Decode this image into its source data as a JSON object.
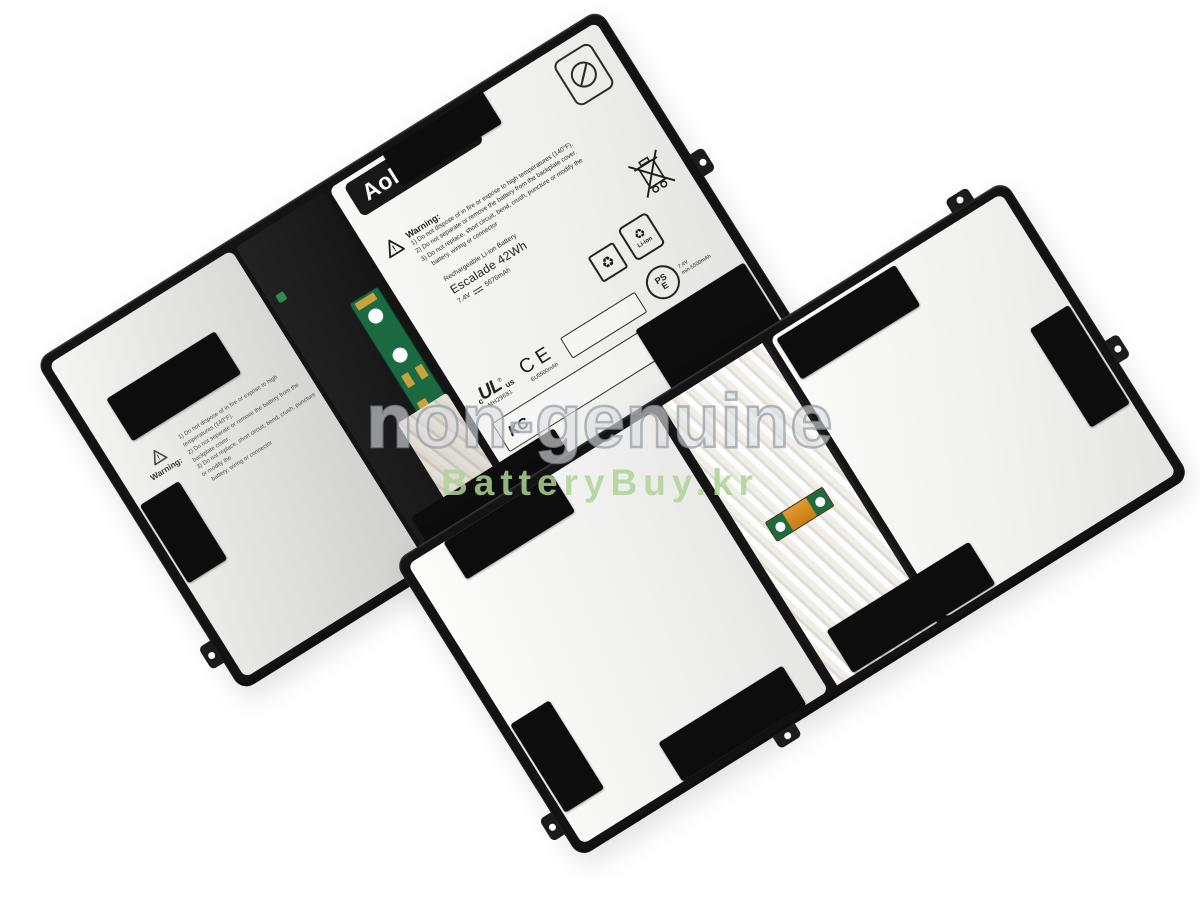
{
  "watermark": {
    "primary": "non-genuine",
    "secondary": "BatteryBuy.kr"
  },
  "label": {
    "brand": "AolsteCell",
    "registered": "®",
    "warning_title": "Warning:",
    "warning_mark": "!",
    "warning_lines": [
      "1) Do not dispose of in fire or expose to high temperatures (140°F).",
      "2) Do not separate or remove the battery from the backplate cover.",
      "3) Do not replace, short circuit, bend, crush, puncture or modify the",
      "battery, wiring or connector"
    ],
    "spec_lines": [
      "Rechargeable Li-ion Battery",
      "Escalade 42Wh"
    ],
    "spec_voltage": "7.4V",
    "spec_capacity": "5676mAh",
    "certs": {
      "ul_prefix": "c",
      "ul": "UL",
      "ul_reg": "®",
      "ul_suffix": "us",
      "ul_file": "MH29681",
      "ce": "CE",
      "ce_capacity": "EU5500mAh",
      "recycle_glyph": "♻",
      "li_ion_recycle_glyph": "♻",
      "li_ion": "Li-ion",
      "pse_line1": "PS",
      "pse_line2": "E",
      "pse_voltage": "7.4V",
      "pse_capacity": "min-5500mAh",
      "kc": "KC"
    }
  },
  "colors": {
    "frame_black": "#141414",
    "pcb_green": "#1b6a41",
    "kapton_orange": "#d4881f",
    "watermark_gray": "#969ca2",
    "watermark_green": "#abd394"
  }
}
